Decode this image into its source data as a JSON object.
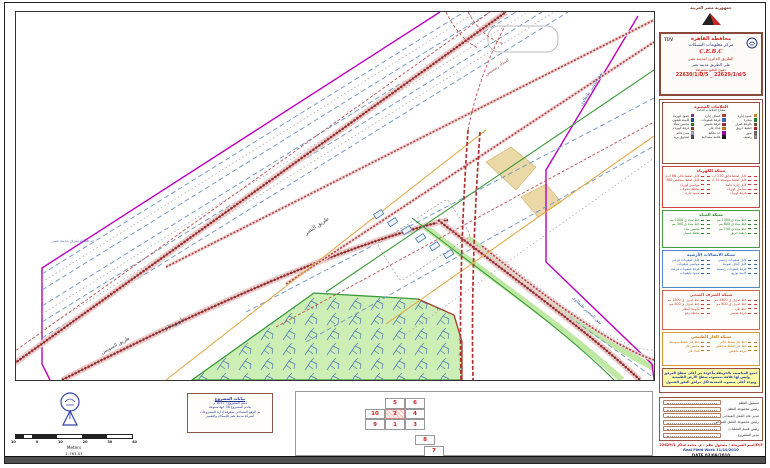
{
  "header": {
    "country": "جمهورية مصر العربية"
  },
  "title_block": {
    "tuv_label": "TÜV",
    "governorate": "محافظة القاهرة",
    "center": "مركز معلومات الشبكات",
    "acronym": "C.E.B.C",
    "line1": "الطريق الدائرى لمدينة نصر",
    "line2": "على الطريق مدينة نصر",
    "line3": "حقوق الطبع محفوظة",
    "sheet_numbers": "22630/1/D/5 _ 22629/1/d/5"
  },
  "legends": [
    {
      "title": "العلامات المميزة",
      "subtitle": "مفتاح العلامات العامة",
      "border": "#9a5040",
      "title_color": "#cc2222",
      "text_color": "#333333",
      "style": "chips",
      "columns": 3,
      "height": 62,
      "items": [
        {
          "label": "عمود إنارة",
          "chip": "#e8a33d"
        },
        {
          "label": "كشاف إنارة",
          "chip": "#cc4444"
        },
        {
          "label": "عمود كهرباء",
          "chip": "#9933bb"
        },
        {
          "label": "شجرة",
          "chip": "#2e8b2e"
        },
        {
          "label": "غرفة تليفونات",
          "chip": "#4477cc"
        },
        {
          "label": "كابينة تليفون",
          "chip": "#2255aa"
        },
        {
          "label": "بالوعة صرف",
          "chip": "#885533"
        },
        {
          "label": "غرفة تفتيش",
          "chip": "#aa3333"
        },
        {
          "label": "محبس مياه",
          "chip": "#2a8a2a"
        },
        {
          "label": "حنفية حريق",
          "chip": "#cc2222"
        },
        {
          "label": "عداد غاز",
          "chip": "#dd8822"
        },
        {
          "label": "غرفة كهرباء",
          "chip": "#cc3333"
        },
        {
          "label": "سور",
          "chip": "#777777"
        },
        {
          "label": "حد ملكية",
          "chip": "#bb00bb"
        },
        {
          "label": "مبنى قائم",
          "chip": "#bbbbbb"
        },
        {
          "label": "رصيف",
          "chip": "#999999"
        },
        {
          "label": "علامة مساحية",
          "chip": "#222222"
        },
        {
          "label": "صندوق بريد",
          "chip": "#555555"
        }
      ]
    },
    {
      "title": "شبكة الكهرباء",
      "border": "#cc4444",
      "title_color": "#cc2222",
      "text_color": "#cc3333",
      "style": "lines",
      "columns": 2,
      "height": 42,
      "items": [
        {
          "label": "كابل ضغط فائق 220 ك.ف"
        },
        {
          "label": "كابل ضغط عالى 66 ك.ف"
        },
        {
          "label": "كابل ضغط متوسط 11 ك.ف"
        },
        {
          "label": "كابل ضغط منخفض 380 ف"
        },
        {
          "label": "كابل إنارة عامة"
        },
        {
          "label": "مواسير كهرباء"
        },
        {
          "label": "شنايش كهرباء"
        },
        {
          "label": "محطة محولات"
        },
        {
          "label": "غرفة كهرباء"
        },
        {
          "label": "عمود إنارة"
        }
      ]
    },
    {
      "title": "شبكة المياه",
      "border": "#44a044",
      "title_color": "#2a8a2a",
      "text_color": "#2a8a2a",
      "style": "lines",
      "columns": 2,
      "height": 38,
      "items": [
        {
          "label": "خط مياه ق 1500 مم"
        },
        {
          "label": "خط مياه ق 1000 مم"
        },
        {
          "label": "خط مياه ق 600 مم"
        },
        {
          "label": "خط مياه ق 300 مم"
        },
        {
          "label": "خط مياه ق 150 مم"
        },
        {
          "label": "محبس مياه"
        },
        {
          "label": "حنفية حريق"
        },
        {
          "label": "نقطة غسيل"
        }
      ]
    },
    {
      "title": "شبكة الاتصالات الأرضية",
      "border": "#5588cc",
      "title_color": "#3366bb",
      "text_color": "#3366bb",
      "style": "lines",
      "columns": 2,
      "height": 38,
      "items": [
        {
          "label": "كابل تليفونات رئيسى"
        },
        {
          "label": "كابل تليفونات فرعى"
        },
        {
          "label": "كابل ألياف ضوئية"
        },
        {
          "label": "مواسير تليفونات"
        },
        {
          "label": "غرفة تليفونات رئيسية"
        },
        {
          "label": "غرفة تليفونات فرعية"
        },
        {
          "label": "كابينة توزيع"
        },
        {
          "label": "عمود تليفونات"
        }
      ]
    },
    {
      "title": "شبكة الصرف الصحى",
      "border": "#cc6650",
      "title_color": "#cc4433",
      "text_color": "#cc4433",
      "style": "lines",
      "columns": 2,
      "height": 40,
      "items": [
        {
          "label": "خط صرف ق 1800 مم"
        },
        {
          "label": "خط صرف ق 1200 مم"
        },
        {
          "label": "خط صرف ق 800 مم"
        },
        {
          "label": "خط صرف ق 400 مم"
        },
        {
          "label": "خط طرد"
        },
        {
          "label": "بالوعة أمطار"
        },
        {
          "label": "غرفة تفتيش"
        },
        {
          "label": "محطة رفع"
        }
      ]
    },
    {
      "title": "شبكة الغاز الطبيعى",
      "border": "#dd9933",
      "title_color": "#cc7711",
      "text_color": "#cc7711",
      "style": "lines",
      "columns": 2,
      "height": 34,
      "items": [
        {
          "label": "خط غاز ضغط عالى"
        },
        {
          "label": "خط غاز ضغط متوسط"
        },
        {
          "label": "خط غاز ضغط منخفض"
        },
        {
          "label": "محبس غاز"
        },
        {
          "label": "غرفة تخفيض"
        },
        {
          "label": "عداد غاز"
        }
      ]
    }
  ],
  "note_box": {
    "lines": [
      "جميع المناسيب بالخريطة مأخوذة من أعلى سطح المرفق",
      "وليس لها علاقة بمنسوب سطح الأرض الطبيعية",
      "ويوجد أعلى منسوب للمعدية لكل مرافق النفق الشمول"
    ]
  },
  "signature": {
    "rows": [
      "مسئول النظم",
      "رئيس مجموعة النظم",
      "مدير عام العمل الميدانى",
      "رئيس مجموعة العمل الميدانى",
      "رئيس قسم العمليات",
      "مدير المشروع"
    ],
    "footer_red": "اسم الشريحة / مسئول نظم : م. محمد شاكر 22629/1/D/5",
    "footer_blue": "Real Field Work 11/10/2010",
    "footer_date": "DATE 03/09/2010"
  },
  "project_box": {
    "title": "بيانات المشروع",
    "lines": [
      "اسم المشروع : 1037 م",
      "يخدم المشروع 38 جهة متنوعة",
      "تم الرفع المساحى بمعرفة إدارة المشروعات",
      "لشركة مدينة نصر للإسكان والتعمير"
    ]
  },
  "sheet_index": {
    "cells": [
      {
        "n": "5",
        "r": 0,
        "c": 1
      },
      {
        "n": "6",
        "r": 0,
        "c": 2
      },
      {
        "n": "10",
        "r": 1,
        "c": 0
      },
      {
        "n": "2",
        "r": 1,
        "c": 1,
        "hl": true
      },
      {
        "n": "4",
        "r": 1,
        "c": 2
      },
      {
        "n": "9",
        "r": 2,
        "c": 0
      },
      {
        "n": "1",
        "r": 2,
        "c": 1
      },
      {
        "n": "3",
        "r": 2,
        "c": 2
      },
      {
        "n": "8",
        "r": 3.45,
        "c": 2.5
      },
      {
        "n": "7",
        "r": 4.5,
        "c": 2.95
      }
    ]
  },
  "scale": {
    "ticks": [
      "10",
      "0",
      "10",
      "20",
      "30",
      "40"
    ],
    "unit": "Meters",
    "ratio": "1:763.47"
  },
  "map": {
    "colors": {
      "boundary": "#bb00bb",
      "road_band": "#a83232",
      "water_line": "#6e93c4",
      "green_area": "#cdeeb5",
      "median": "#bfe8a3",
      "gas": "#e2a43c",
      "green_line": "#3a9a3a"
    },
    "labels": [
      {
        "text": "طريق النصر",
        "x": 290,
        "y": 223,
        "rot": -34,
        "size": 5.5,
        "color": "#444455"
      },
      {
        "text": "طريق عام",
        "x": 150,
        "y": 318,
        "rot": -28,
        "size": 5,
        "color": "#444455"
      },
      {
        "text": "نفق المشير طنطاوى",
        "x": 566,
        "y": 94,
        "rot": -58,
        "size": 4.5,
        "color": "#4466aa"
      },
      {
        "text": "نفق المشير طنطاوى",
        "x": 556,
        "y": 286,
        "rot": 43,
        "size": 4.5,
        "color": "#4466aa"
      },
      {
        "text": "حد قطاع شرق مدينة نصر",
        "x": 36,
        "y": 230,
        "rot": 0,
        "size": 4,
        "color": "#6677cc"
      },
      {
        "text": "طريق السويس",
        "x": 86,
        "y": 342,
        "rot": -28,
        "size": 5,
        "color": "#444455"
      },
      {
        "text": "امتداد رمسيس",
        "x": 470,
        "y": 64,
        "rot": -34,
        "size": 4.5,
        "color": "#994444"
      }
    ]
  }
}
